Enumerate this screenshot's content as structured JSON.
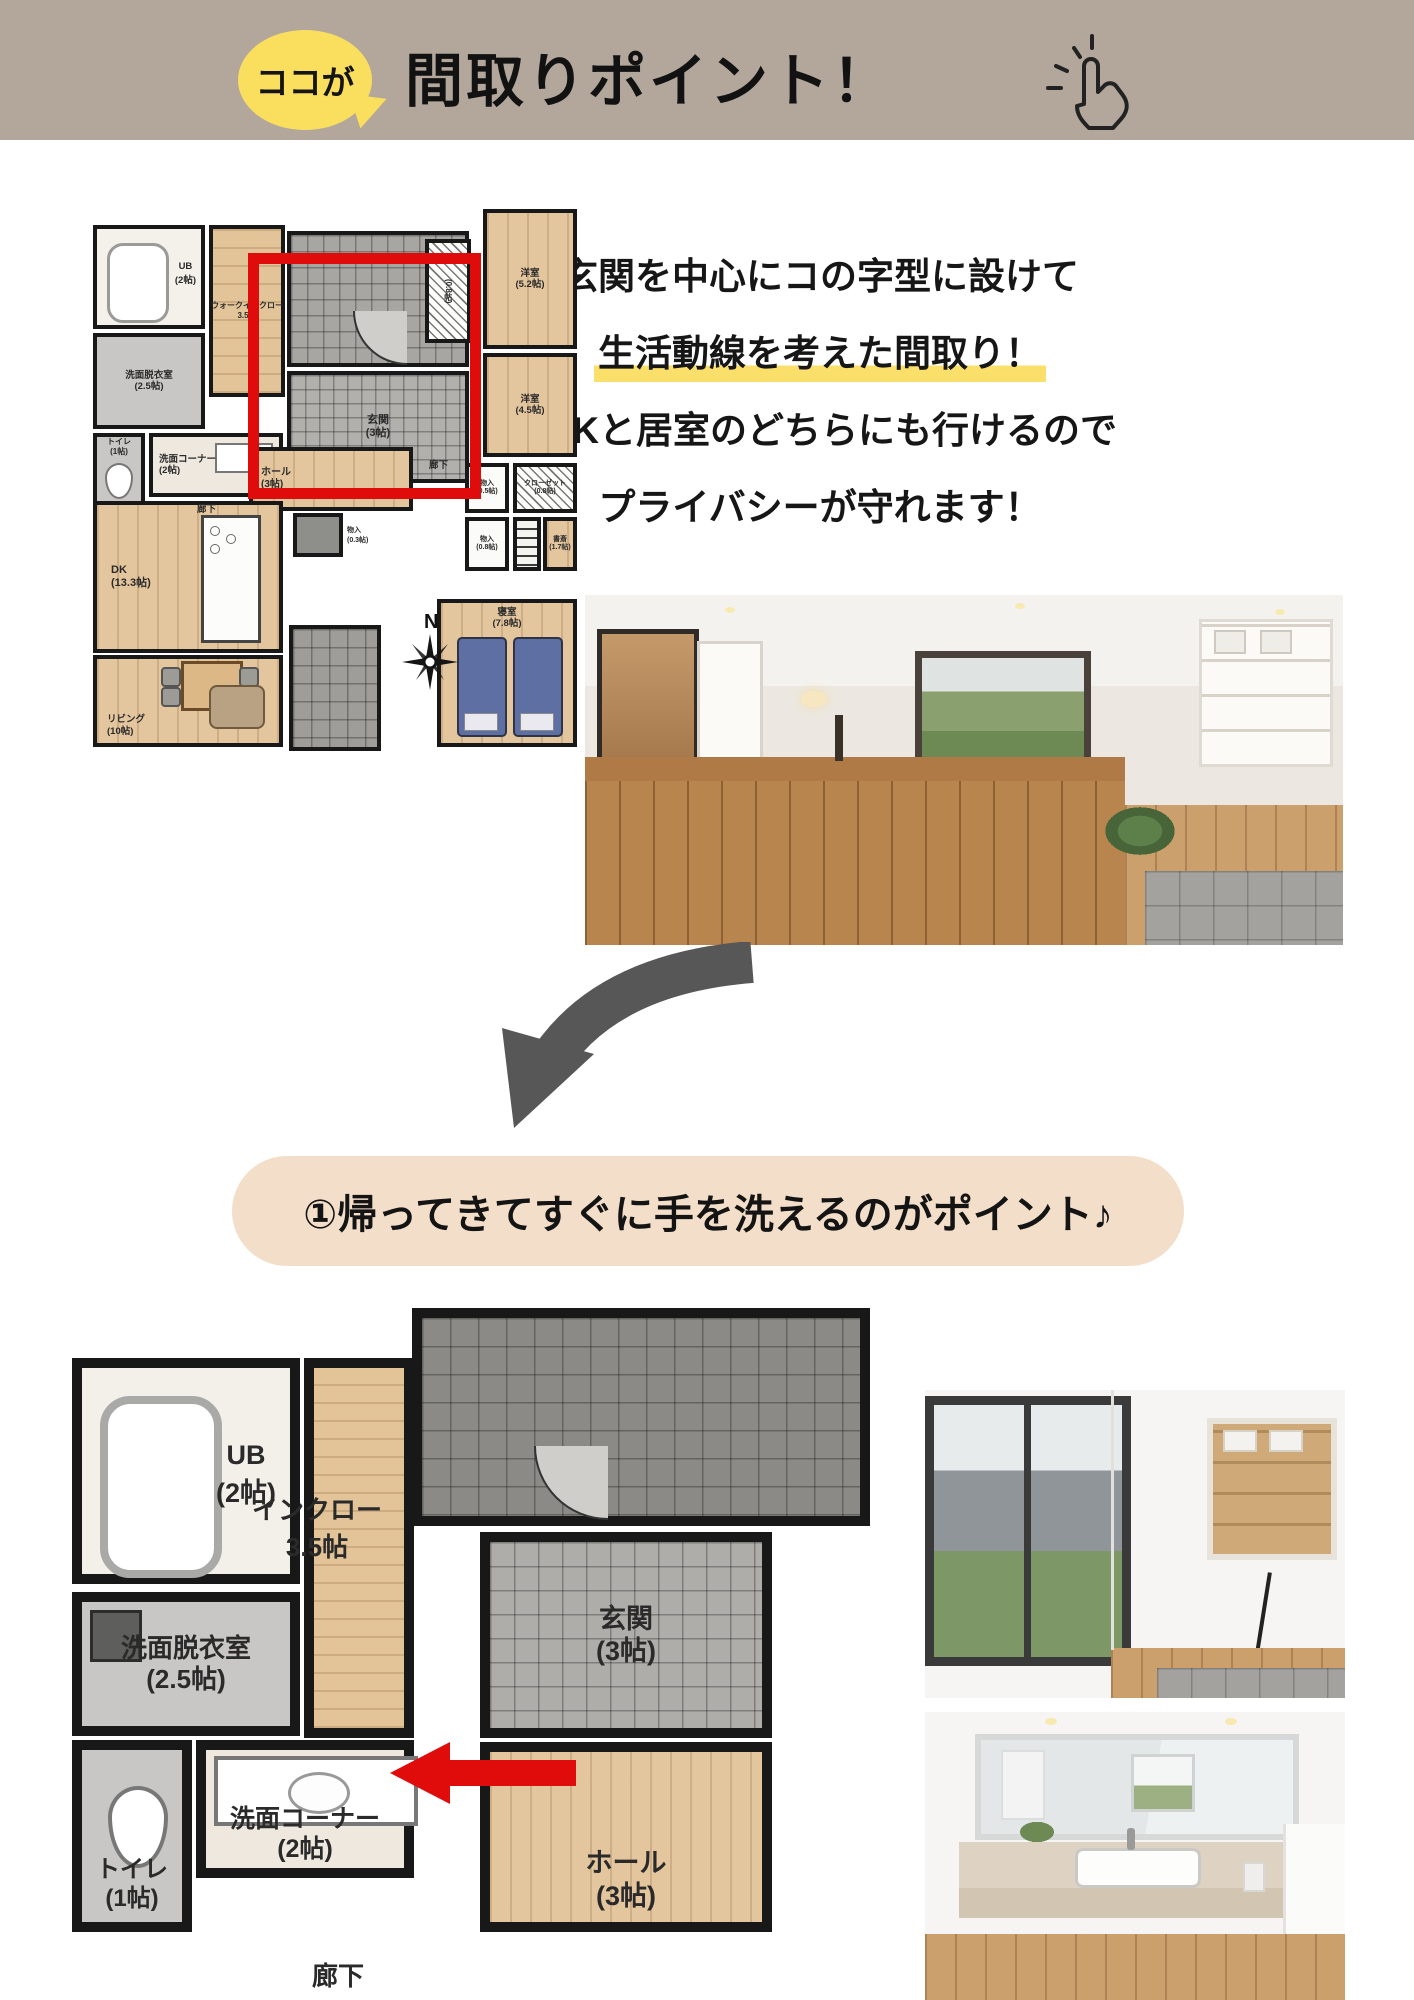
{
  "colors": {
    "header_beige": "#b2a79a",
    "bubble_yellow": "#fadf5e",
    "highlight_yellow": "#fbdf6b",
    "banner_beige": "#f3dfc9",
    "accent_red": "#e00b0b"
  },
  "header": {
    "bubble_label": "ココが",
    "title": "間取りポイント！"
  },
  "intro": {
    "line1": "玄関を中心にコの字型に設けて",
    "line2": "生活動線を考えた間取り！",
    "line3": "LDKと居室のどちらにも行けるので",
    "line4": "プライバシーが守れます！"
  },
  "main_plan": {
    "compass_label": "N",
    "rooms": {
      "ub": {
        "name": "UB",
        "size": "(2帖)"
      },
      "wic": {
        "name": "ウォークインクロー",
        "size": "3.5帖"
      },
      "senmen_datsui": {
        "name": "洗面脱衣室",
        "size": "(2.5帖)"
      },
      "toilet": {
        "name": "トイレ",
        "size": "(1帖)"
      },
      "senmen_corner": {
        "name": "洗面コーナー",
        "size": "(2帖)"
      },
      "rouka_left": {
        "name": "廊下"
      },
      "genkan": {
        "name": "玄関",
        "size": "(3帖)"
      },
      "hall": {
        "name": "ホール",
        "size": "(3帖)"
      },
      "rouka_right": {
        "name": "廊下"
      },
      "closet_top": {
        "name": "(0.8帖)"
      },
      "yoshitsu_52": {
        "name": "洋室",
        "size": "(5.2帖)"
      },
      "yoshitsu_45": {
        "name": "洋室",
        "size": "(4.5帖)"
      },
      "mono_05": {
        "name": "物入",
        "size": "(0.5帖)"
      },
      "closet_08": {
        "name": "クローゼット",
        "size": "(0.8帖)"
      },
      "mono_08": {
        "name": "物入",
        "size": "(0.8帖)"
      },
      "shosai": {
        "name": "書斎",
        "size": "(1.7帖)"
      },
      "shinshitsu": {
        "name": "寝室",
        "size": "(7.8帖)"
      },
      "mono_03": {
        "name": "物入",
        "size": "(0.3帖)"
      },
      "dk": {
        "name": "DK",
        "size": "(13.3帖)"
      },
      "living": {
        "name": "リビング",
        "size": "(10帖)"
      }
    }
  },
  "banner": {
    "text": "①帰ってきてすぐに手を洗えるのがポイント♪"
  },
  "zoom_plan": {
    "rooms": {
      "ub": {
        "name": "UB",
        "size": "(2帖)"
      },
      "wic": {
        "name": "インクロー",
        "size": "3.5帖"
      },
      "senmen_datsui": {
        "name": "洗面脱衣室",
        "size": "(2.5帖)"
      },
      "genkan": {
        "name": "玄関",
        "size": "(3帖)"
      },
      "hall": {
        "name": "ホール",
        "size": "(3帖)"
      },
      "toilet": {
        "name": "トイレ",
        "size": "(1帖)"
      },
      "senmen_corner": {
        "name": "洗面コーナー",
        "size": "(2帖)"
      },
      "rouka": {
        "name": "廊下"
      }
    }
  }
}
